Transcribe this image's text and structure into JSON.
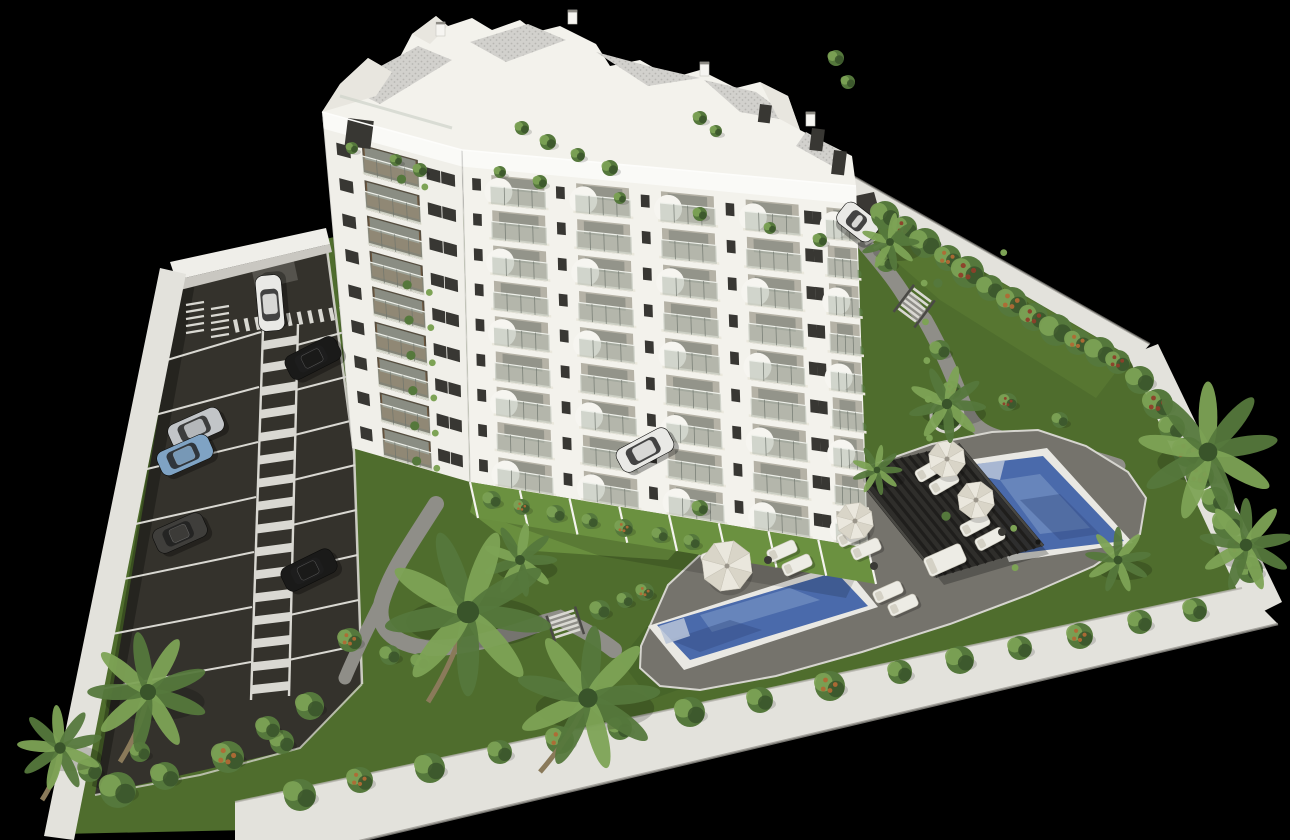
{
  "scene": {
    "kind": "aerial-3d-architectural-rendering",
    "subject": "white apartment building with landscaped grounds, parking lot and two swimming pools on a black background"
  },
  "colors": {
    "background": "#000000",
    "lawn": "#4f6d2d",
    "lawn_light": "#6b9140",
    "lawn_mid": "#587833",
    "lawn_dark": "#3f5a26",
    "asphalt": "#34322c",
    "marking": "#d9d8d2",
    "wall_top": "#e3e2dc",
    "wall_face": "#c9c7c1",
    "wall_bright": "#efeee9",
    "path": "#8f8e88",
    "deck": "#75736c",
    "pool_coping": "#e9e8e3",
    "pool_water": "#4a6aab",
    "pool_water_light": "#8ba6cf",
    "pool_water_dark": "#31497f",
    "pool_steps": "#b9c4d8",
    "building_wall": "#f3f2ec",
    "building_wall_shade": "#f0efe9",
    "parapet": "#fafaf7",
    "recess_front": "#b5b2a6",
    "recess_side": "#564e40",
    "glass_door": "#8f9087",
    "slab": "#eae8dd",
    "railing_glass": "#b2b9ae",
    "railing_frame": "#6e746c",
    "wood": "#7a5a3a",
    "window_glass": "#383733",
    "roof_deck": "#d2d1cd",
    "roof_speckle": "#b7b6b2",
    "pergola": "#2d2c29",
    "pergola_slat": "#1f1e1c",
    "pergola_rail": "#4a4944",
    "furniture": "#edece5",
    "furniture_shade": "#d4d1c5",
    "plant": "#55783c",
    "plant_light": "#7da355",
    "plant_dark": "#39542a",
    "accent_orange": "#b06a35",
    "accent_red": "#8e3f2a",
    "trunk": "#8a7a5a",
    "car_white": "#e9e9e6",
    "car_black": "#1a1a19",
    "car_silver": "#c2c5c8",
    "car_blue": "#7fa3c4",
    "car_gray": "#3f3e3b"
  },
  "site": {
    "perimeter_wall": {
      "material": "white-concrete",
      "sides_visible": 5
    },
    "parking": {
      "marked_bays_left": 7,
      "marked_bays_right": 8,
      "zebra_aisle": true,
      "entrance_crosswalk": true,
      "moto_bays": true,
      "cars": [
        {
          "color": "white"
        },
        {
          "color": "black"
        },
        {
          "color": "silver"
        },
        {
          "color": "blue"
        },
        {
          "color": "gray"
        },
        {
          "color": "black"
        },
        {
          "color": "white"
        },
        {
          "color": "white"
        }
      ]
    },
    "building": {
      "floors_visible": 9,
      "balcony_columns_front": 5,
      "balcony_columns_side": 1,
      "penthouse_levels": 2,
      "facade": "white with glass balconies and planted terraces"
    },
    "garden": {
      "pools": 2,
      "pergola": 1,
      "parasols": 4,
      "sun_loungers": 11,
      "daybed": 1,
      "palm_trees": 11,
      "walking_paths": 2,
      "staircases": 2,
      "round_planter": 1
    }
  }
}
